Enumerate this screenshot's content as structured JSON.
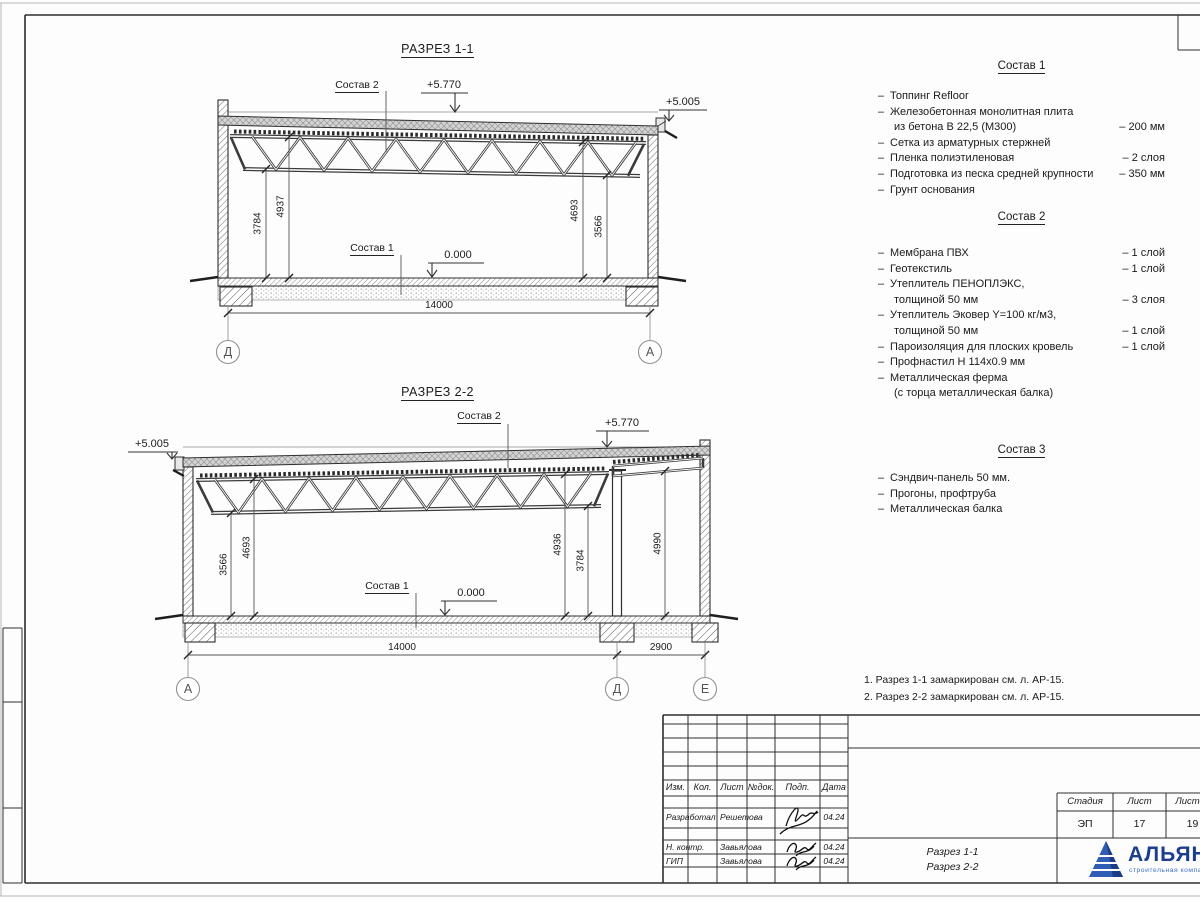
{
  "bullet": "–",
  "sections": [
    {
      "title": "РАЗРЕЗ 1-1",
      "composition2_label": "Состав 2",
      "composition1_label": "Состав 1",
      "elev_high": "+5.770",
      "elev_low": "+5.005",
      "elev_zero": "0.000",
      "dims": {
        "left_outer": "3784",
        "left_inner": "4937",
        "right_inner": "4693",
        "right_outer": "3566",
        "span": "14000"
      },
      "axes": {
        "left": "Д",
        "right": "А"
      }
    },
    {
      "title": "РАЗРЕЗ 2-2",
      "composition2_label": "Состав 2",
      "composition1_label": "Состав 1",
      "elev_high": "+5.770",
      "elev_low": "+5.005",
      "elev_zero": "0.000",
      "dims": {
        "left_outer": "3566",
        "left_inner": "4693",
        "mid_inner": "4936",
        "mid_outer": "3784",
        "right_bay": "4990",
        "span": "14000",
        "span_right": "2900"
      },
      "axes": {
        "left": "А",
        "mid": "Д",
        "right": "Е"
      }
    }
  ],
  "compositions": [
    {
      "title": "Состав 1",
      "items": [
        {
          "text": "Топпинг Refloor",
          "text2": "",
          "value": ""
        },
        {
          "text": "Железобетонная  монолитная плита",
          "text2": "из бетона В 22,5 (М300)",
          "value": "– 200 мм"
        },
        {
          "text": "Сетка из арматурных стержней",
          "text2": "",
          "value": ""
        },
        {
          "text": "Пленка полиэтиленовая",
          "text2": "",
          "value": "– 2 слоя"
        },
        {
          "text": "Подготовка из песка средней крупности",
          "text2": "",
          "value": "– 350 мм"
        },
        {
          "text": "Грунт основания",
          "text2": "",
          "value": ""
        }
      ]
    },
    {
      "title": "Состав 2",
      "items": [
        {
          "text": "Мембрана ПВХ",
          "text2": "",
          "value": "– 1 слой"
        },
        {
          "text": "Геотекстиль",
          "text2": "",
          "value": "– 1 слой"
        },
        {
          "text": "Утеплитель ПЕНОПЛЭКС,",
          "text2": "толщиной 50 мм",
          "value": "– 3 слоя"
        },
        {
          "text": "Утеплитель Эковер Y=100 кг/м3,",
          "text2": "толщиной 50 мм",
          "value": "– 1 слой"
        },
        {
          "text": "Пароизоляция для плоских кровель",
          "text2": "",
          "value": "– 1 слой"
        },
        {
          "text": "Профнастил Н 114х0.9 мм",
          "text2": "",
          "value": ""
        },
        {
          "text": "Металлическая ферма",
          "text2": "(с торца металлическая балка)",
          "value": ""
        }
      ]
    },
    {
      "title": "Состав 3",
      "items": [
        {
          "text": "Сэндвич-панель 50 мм.",
          "text2": "",
          "value": ""
        },
        {
          "text": "Прогоны, профтруба",
          "text2": "",
          "value": ""
        },
        {
          "text": "Металлическая балка",
          "text2": "",
          "value": ""
        }
      ]
    }
  ],
  "notes": [
    "1. Разрез 1-1 замаркирован см. л. АР-15.",
    "2. Разрез 2-2 замаркирован см. л. АР-15."
  ],
  "title_block": {
    "columns": [
      "Изм.",
      "Кол.",
      "Лист",
      "№док.",
      "Подп.",
      "Дата"
    ],
    "rows": [
      {
        "role": "Разработал",
        "name": "Решетова",
        "date": "04.24"
      },
      {
        "role": "Н. контр.",
        "name": "Завьялова",
        "date": "04.24"
      },
      {
        "role": "ГИП",
        "name": "Завьялова",
        "date": "04.24"
      }
    ],
    "doc_title_line1": "Разрез 1-1",
    "doc_title_line2": "Разрез 2-2",
    "stage_headers": [
      "Стадия",
      "Лист",
      "Листов"
    ],
    "stage_values": [
      "ЭП",
      "17",
      "19"
    ],
    "company": "АЛЬЯНС",
    "company_subtitle": "строительная компания",
    "brand_color": "#1b3c8f",
    "brand_accent": "#3f6fd1"
  }
}
